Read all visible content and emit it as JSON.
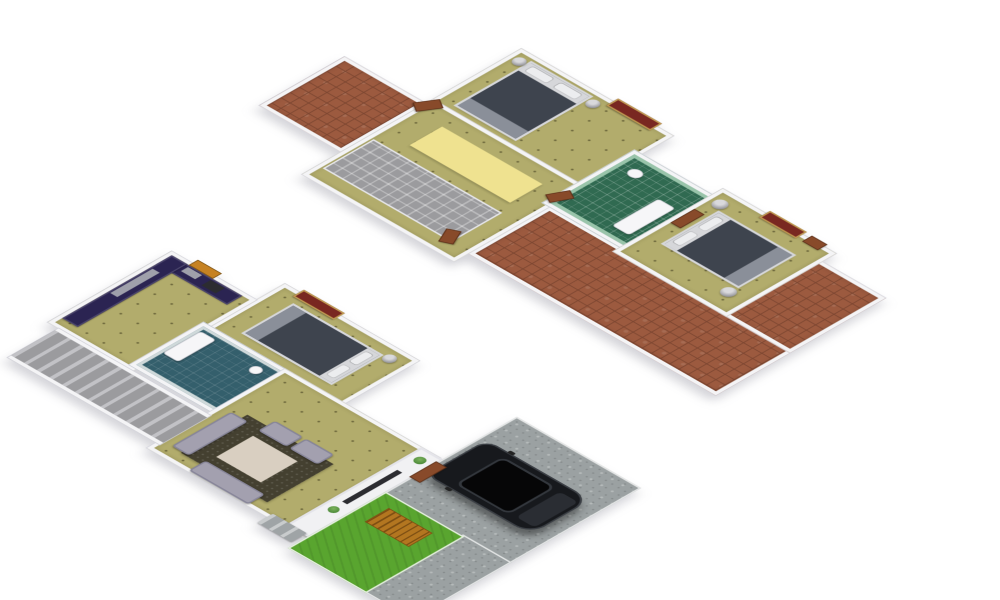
{
  "scene": {
    "description": "3D isometric render of a two-storey house floor plan, two tilted plans on a white background",
    "upper_floor": {
      "label": "Upper floor plan",
      "rooms": {
        "bedroom1": {
          "label": "Bedroom with double bed, nightstands and maroon wall art"
        },
        "bedroom2": {
          "label": "Bedroom with double bed, round poufs and dresser"
        },
        "bathroom": {
          "label": "Bathroom with dark green tiled floor, toilet and tub"
        },
        "hall": {
          "label": "Hallway with gray tiled stair landing and yellow rug"
        },
        "terraceLeft": {
          "label": "Open terrace with terracotta tile floor"
        },
        "terraceMain": {
          "label": "Large open terrace with terracotta tile floor"
        }
      }
    },
    "ground_floor": {
      "label": "Ground floor plan",
      "rooms": {
        "bedroom3": {
          "label": "Bedroom with double bed and maroon wall art"
        },
        "kitchen": {
          "label": "Kitchen with dark indigo L-shaped counters and orange wall shelf"
        },
        "bathroom2": {
          "label": "Bathroom with dark teal tiled floor and tub"
        },
        "stairs": {
          "label": "Staircase with white stringers"
        },
        "hall2": {
          "label": "Hallway and dining area"
        },
        "living": {
          "label": "Living room with sofas around a dark patterned rug"
        },
        "tvUnit": {
          "label": "White TV unit with television and plant"
        },
        "mainDoor": {
          "label": "Main entrance door"
        },
        "driveway": {
          "label": "Concrete driveway with parked black car"
        },
        "lawn": {
          "label": "Green lawn with orange striped doormat"
        }
      }
    }
  },
  "colors": {
    "bg": "#ffffff",
    "wall": "#f4f4f6",
    "wallEdge": "#d6d6de",
    "olive": "#b2ac69",
    "oliveDot": "#6f6a3c",
    "brick": "#9e5a3d",
    "brickLine": "#7e4630",
    "bathGreenFloor": "#2e6b51",
    "bathGreenWall": "#98c4a9",
    "bathTealFloor": "#335f6d",
    "stairGray": "#9b9b9e",
    "stairLight": "#c2c2c6",
    "rugYellow": "#f0e28d",
    "bedDark": "#3e444e",
    "bedMid": "#8a8f99",
    "bedLight": "#d6d7da",
    "pillow": "#ecedef",
    "maroon": "#7c2720",
    "frameGold": "#c09a4e",
    "door": "#8a4a28",
    "doorDark": "#5c2f17",
    "kitchenNavy": "#2b2454",
    "counterGray": "#9fa0ab",
    "orange": "#c8821f",
    "sofa": "#a3a0b0",
    "sofaDark": "#87859a",
    "rugDark": "#44402f",
    "rugCenter": "#d9cfc0",
    "tvWhite": "#f1f1f3",
    "plant": "#4c8c37",
    "carBody": "#17191d",
    "carGlass": "#060607",
    "carTrim": "#3c4046",
    "driveway": "#9ba1a2",
    "drivewaySpeck": "#b6bbbb",
    "lawn": "#57a62b",
    "mat": "#b5761c"
  }
}
